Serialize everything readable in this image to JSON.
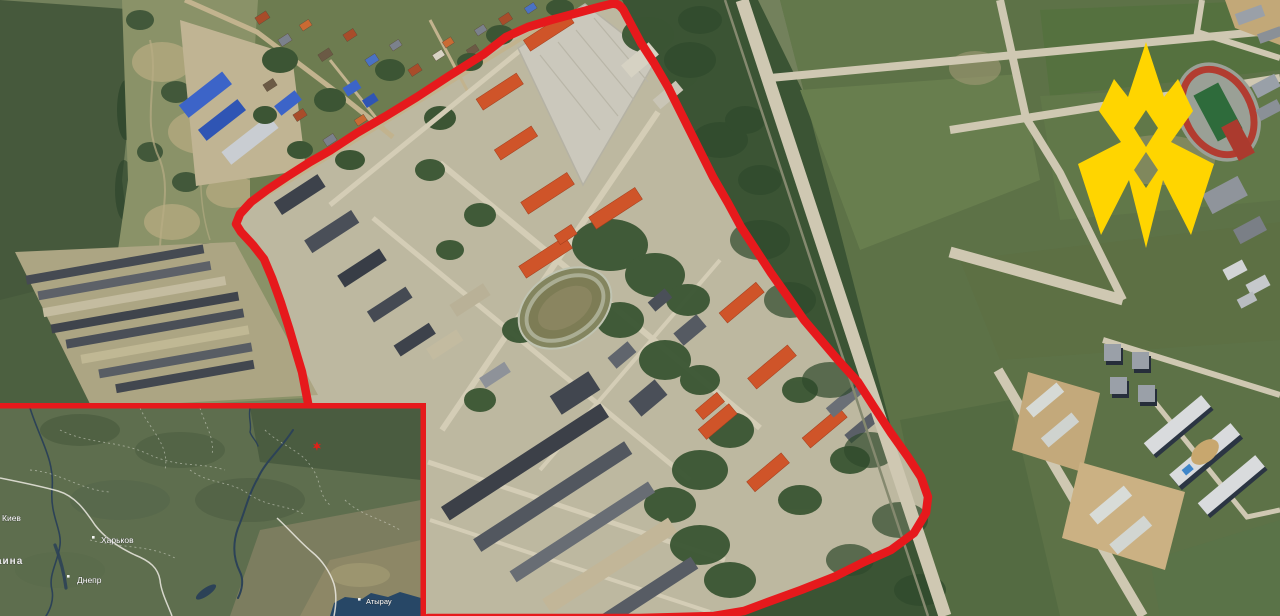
{
  "colors": {
    "outline_red": "#e6191c",
    "logo_yellow": "#ffd500",
    "inset_border_red": "#e6191c",
    "marker_red": "#e02018",
    "label_white": "#ffffff"
  },
  "overlay": {
    "outline_path": "M 308 403 L 302 372 L 296 352 L 289 328 L 281 303 L 272 278 L 264 259 L 253 245 L 241 232 L 236 224 L 240 214 L 251 202 L 267 190 L 288 176 L 310 162 L 331 150 L 357 133 L 386 116 L 417 97 L 449 76 L 484 54 L 506 37 L 528 27 L 551 20 L 577 13 L 599 7 L 611 4 Q 620 2 625 13 L 641 43 L 654 63 L 668 87 L 683 117 L 698 147 L 713 177 L 728 203 L 741 227 L 756 250 L 771 273 L 788 297 L 804 320 L 821 340 L 838 360 L 858 382 L 874 407 L 891 433 L 908 457 L 921 477 L 928 497 L 926 513 L 914 533 L 891 550 L 864 562 L 834 577 L 801 590 L 768 602 L 744 611 L 714 616 L 640 618 L 428 618"
  },
  "logo": {
    "name": "ATESH flame tamga",
    "transform": "translate(1070,35)",
    "path": "M 76 7 L 94 62 L 108 44 L 123 76 L 101 107 L 144 129 L 121 200 L 93 145 L 76 213 L 59 145 L 31 200 L 8 129 L 51 107 L 29 76 L 44 44 L 58 62 Z M 76 75 L 88 93 L 76 112 L 64 93 Z M 76 117 L 88 135 L 76 153 L 64 135 Z"
  },
  "inset": {
    "marker": {
      "transform": "translate(317,446)"
    },
    "labels": [
      {
        "id": "kyiv",
        "text": "Киев",
        "x": "2",
        "y": "521"
      },
      {
        "id": "country",
        "text": "Украина",
        "x": "-24",
        "y": "564"
      },
      {
        "id": "kharkiv",
        "text": "Харьков",
        "x": "101",
        "y": "543"
      },
      {
        "id": "dnipro",
        "text": "Днепр",
        "x": "77",
        "y": "583"
      },
      {
        "id": "atyrau",
        "text": "Атырау",
        "x": "366",
        "y": "604"
      }
    ],
    "dots": [
      {
        "x": "92",
        "y": "536"
      },
      {
        "x": "67",
        "y": "575"
      },
      {
        "x": "358",
        "y": "598"
      }
    ]
  }
}
